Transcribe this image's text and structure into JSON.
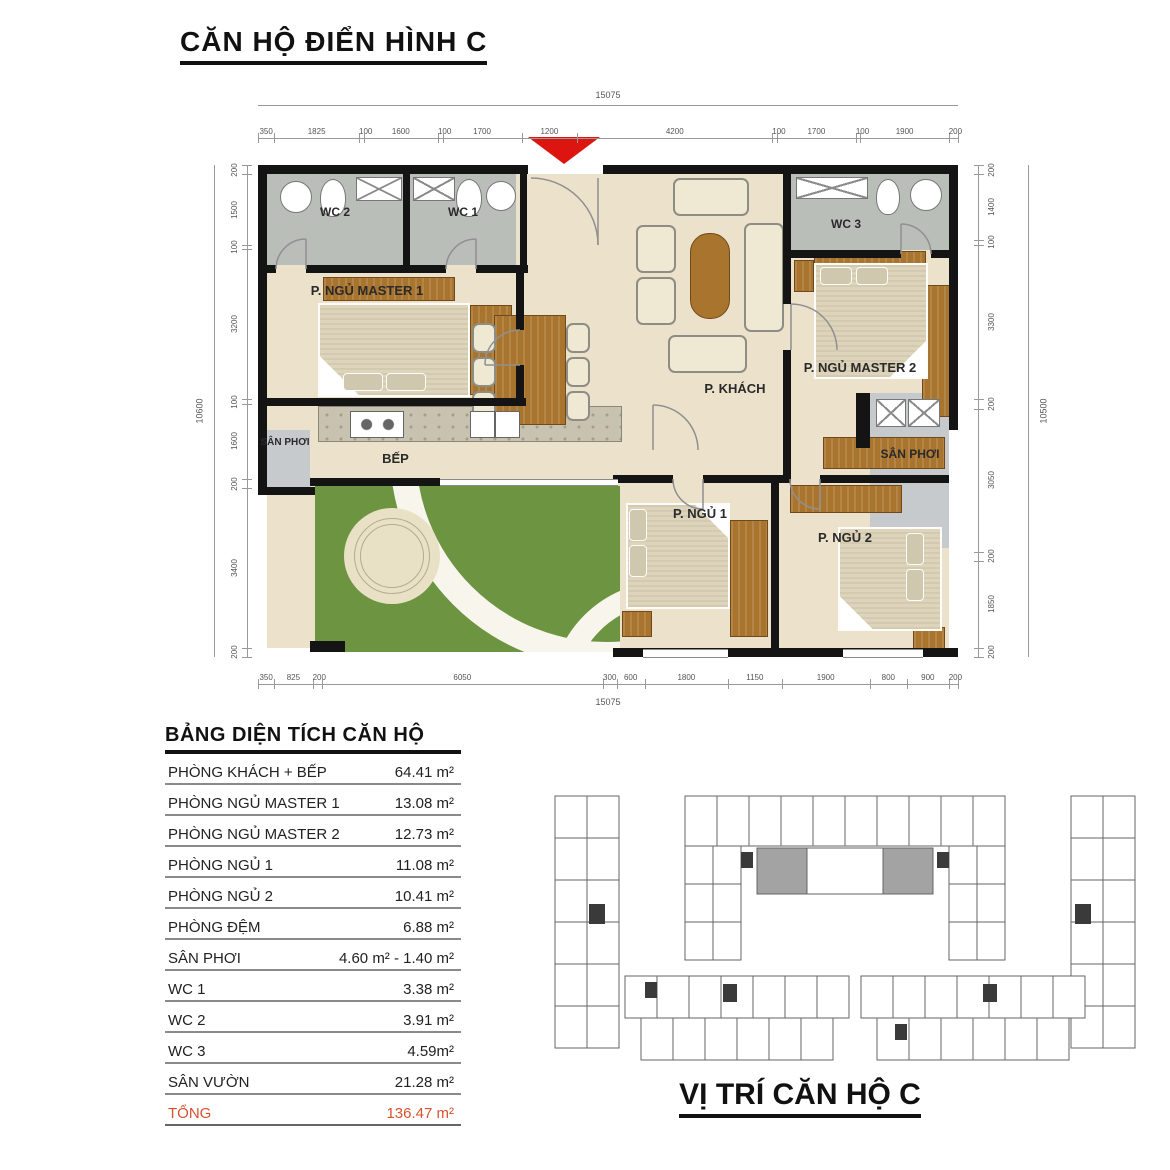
{
  "title": "CĂN HỘ ĐIỂN HÌNH C",
  "plan": {
    "rooms": {
      "wc2": "WC 2",
      "wc1": "WC 1",
      "wc3": "WC 3",
      "master1": "P. NGỦ MASTER 1",
      "master2": "P. NGỦ MASTER 2",
      "khach": "P. KHÁCH",
      "bep": "BẾP",
      "ngu1": "P. NGỦ 1",
      "ngu2": "P. NGỦ 2",
      "san_phoi_left": "SÂN PHƠI",
      "san_phoi_right": "SÂN PHƠI"
    },
    "dims": {
      "top": [
        350,
        1825,
        100,
        1600,
        100,
        1700,
        1200,
        4200,
        100,
        1700,
        100,
        1900,
        200
      ],
      "top_total": "15075",
      "bottom": [
        350,
        825,
        200,
        6050,
        300,
        600,
        1800,
        1150,
        1900,
        800,
        900,
        200
      ],
      "bottom_total": "15075",
      "left": [
        200,
        1500,
        100,
        3200,
        100,
        1600,
        200,
        3400,
        200
      ],
      "left_total": "10600",
      "right": [
        200,
        1400,
        100,
        3300,
        200,
        3050,
        200,
        1850,
        200
      ],
      "right_total": "10500"
    }
  },
  "area_table": {
    "title": "BẢNG DIỆN TÍCH CĂN HỘ",
    "rows": [
      {
        "label": "PHÒNG KHÁCH + BẾP",
        "value": "64.41 m²"
      },
      {
        "label": "PHÒNG NGỦ MASTER 1",
        "value": "13.08 m²"
      },
      {
        "label": "PHÒNG NGỦ MASTER 2",
        "value": "12.73 m²"
      },
      {
        "label": "PHÒNG NGỦ 1",
        "value": "11.08 m²"
      },
      {
        "label": "PHÒNG NGỦ 2",
        "value": "10.41 m²"
      },
      {
        "label": "PHÒNG ĐỆM",
        "value": "6.88 m²"
      },
      {
        "label": "SÂN PHƠI",
        "value": "4.60 m² - 1.40 m²"
      },
      {
        "label": "WC 1",
        "value": "3.38 m²"
      },
      {
        "label": "WC 2",
        "value": "3.91 m²"
      },
      {
        "label": "WC 3",
        "value": "4.59m²"
      },
      {
        "label": "SÂN VƯỜN",
        "value": "21.28 m²"
      },
      {
        "label": "TỔNG",
        "value": "136.47 m²",
        "highlight": true
      }
    ]
  },
  "site": {
    "title": "VỊ TRÍ CĂN HỘ C"
  },
  "colors": {
    "wall": "#141414",
    "floor": "#ece2cb",
    "tile": "#b9beb9",
    "balc": "#c6cacc",
    "wood": "#a9742e",
    "grass": "#6d9440",
    "path": "#f7f5ec",
    "patiocol": "#e9e1c6",
    "red": "#dd1510",
    "totalred": "#d9512e",
    "site_highlight": "#a3a3a3"
  }
}
